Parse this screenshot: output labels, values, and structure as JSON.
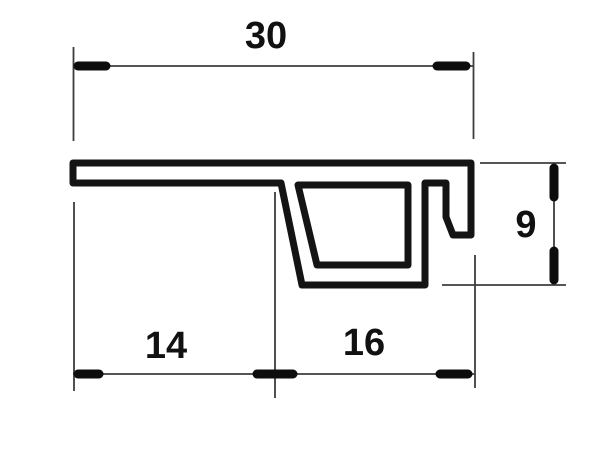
{
  "drawing": {
    "kind": "technical-profile-cross-section",
    "description": "Outline drawing of an extruded sill/trim profile: long flat top flange, slanted-wall hollow trapezoid chamber under the right half, and a J-hook return on the right edge, annotated with linear dimensions.",
    "dimensions": {
      "total_width": "30",
      "left_width": "14",
      "right_width": "16",
      "right_height": "9"
    },
    "colors": {
      "background": "#ffffff",
      "profile_line": "#141414",
      "extension_line": "#3d3d3d",
      "tick": "#0d0d0d",
      "text": "#111111"
    }
  }
}
